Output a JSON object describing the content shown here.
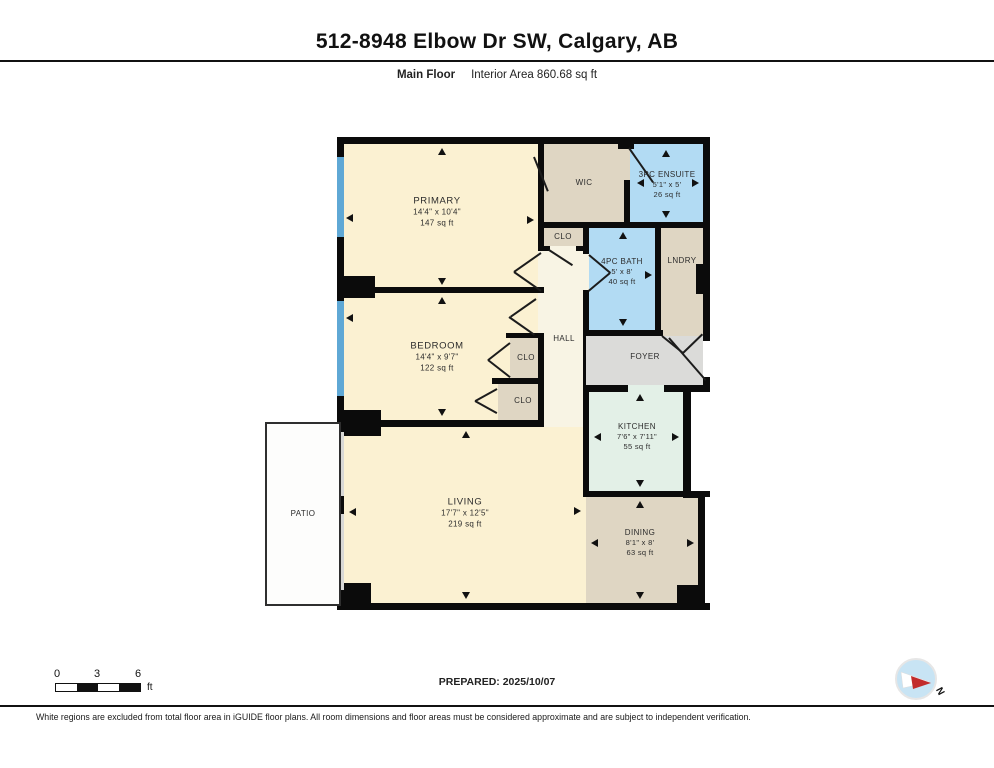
{
  "header": {
    "title": "512-8948 Elbow Dr SW, Calgary, AB",
    "floor_label": "Main Floor",
    "area_label": "Interior Area 860.68 sq ft"
  },
  "rooms": [
    {
      "name": "PRIMARY",
      "dims": "14'4\" x 10'4\"",
      "area": "147 sq ft"
    },
    {
      "name": "WIC"
    },
    {
      "name": "3PC ENSUITE",
      "dims": "5'1\" x 5'",
      "area": "26 sq ft"
    },
    {
      "name": "CLO"
    },
    {
      "name": "4PC BATH",
      "dims": "5' x 8'",
      "area": "40 sq ft"
    },
    {
      "name": "LNDRY"
    },
    {
      "name": "HALL"
    },
    {
      "name": "FOYER"
    },
    {
      "name": "BEDROOM",
      "dims": "14'4\" x 9'7\"",
      "area": "122 sq ft"
    },
    {
      "name": "CLO"
    },
    {
      "name": "CLO"
    },
    {
      "name": "KITCHEN",
      "dims": "7'6\" x 7'11\"",
      "area": "55 sq ft"
    },
    {
      "name": "LIVING",
      "dims": "17'7\" x 12'5\"",
      "area": "219 sq ft"
    },
    {
      "name": "DINING",
      "dims": "8'1\" x 8'",
      "area": "63 sq ft"
    },
    {
      "name": "PATIO"
    }
  ],
  "scale_bar": {
    "tick0": "0",
    "tick1": "3",
    "tick2": "6",
    "unit": "ft"
  },
  "prepared": "PREPARED: 2025/10/07",
  "compass": {
    "north_label": "N"
  },
  "disclaimer": "White regions are excluded from total floor area in iGUIDE floor plans. All room dimensions and floor areas must be considered approximate and are subject to independent verification.",
  "colors": {
    "room_cream": "#FBF1D2",
    "hall_cream": "#F8F4E4",
    "closet_tan": "#DFD6C3",
    "bath_blue": "#B2DBF3",
    "kitchen_mint": "#E3F0E7",
    "foyer_gray": "#DBDBD9",
    "window_blue": "#5FA8D5",
    "wall_black": "#0B0B0B",
    "compass_blue": "#C8E4F4",
    "compass_red": "#C22B2B"
  }
}
